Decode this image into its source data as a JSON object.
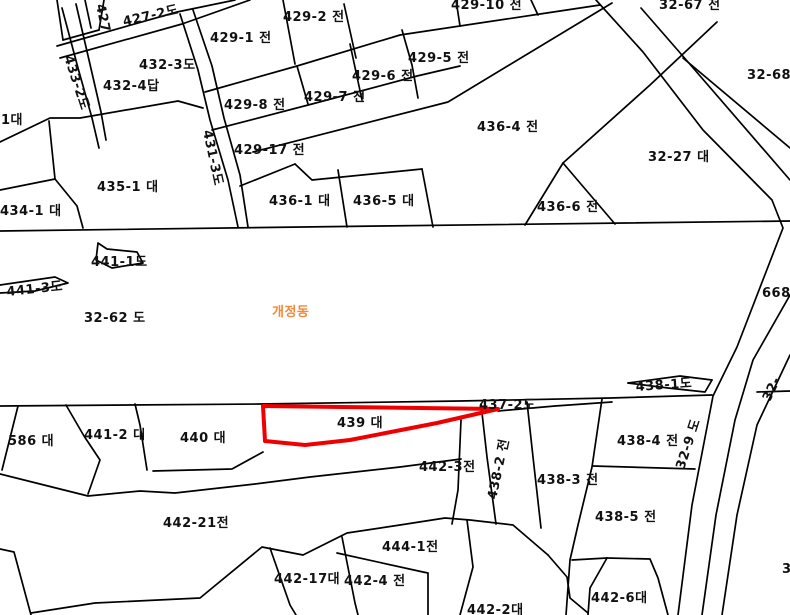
{
  "map": {
    "type": "cadastral-parcel-map",
    "district_name": "개정동",
    "colors": {
      "background": "#ffffff",
      "boundary": "#000000",
      "label": "#111111",
      "district_label": "#f08a3c",
      "highlight": "#ee0000"
    },
    "highlight_parcel": {
      "label": "439 대",
      "points": "263,406 498,409 437,423 350,440 305,445 265,441",
      "stroke_width": 4
    },
    "labels": [
      {
        "text": "427",
        "x": 96,
        "y": 5,
        "rot": 78
      },
      {
        "text": "427-2도",
        "x": 124,
        "y": 26,
        "rot": -13
      },
      {
        "text": "429-2 전",
        "x": 283,
        "y": 21
      },
      {
        "text": "429-1 전",
        "x": 210,
        "y": 42
      },
      {
        "text": "432-3도",
        "x": 139,
        "y": 69
      },
      {
        "text": "432-4답",
        "x": 103,
        "y": 90
      },
      {
        "text": "429-8 전",
        "x": 224,
        "y": 109
      },
      {
        "text": "429-7 전",
        "x": 304,
        "y": 101
      },
      {
        "text": "429-6 전",
        "x": 352,
        "y": 80
      },
      {
        "text": "429-5 전",
        "x": 408,
        "y": 62
      },
      {
        "text": "429-10 전",
        "x": 451,
        "y": 9
      },
      {
        "text": "32-67 전",
        "x": 659,
        "y": 9
      },
      {
        "text": "32-68",
        "x": 747,
        "y": 79
      },
      {
        "text": "429-17 전",
        "x": 234,
        "y": 154
      },
      {
        "text": "433-2도",
        "x": 64,
        "y": 57,
        "rot": 72
      },
      {
        "text": "431-3도",
        "x": 203,
        "y": 131,
        "rot": 78
      },
      {
        "text": "1대",
        "x": 1,
        "y": 124
      },
      {
        "text": "435-1 대",
        "x": 97,
        "y": 191
      },
      {
        "text": "434-1 대",
        "x": 0,
        "y": 215
      },
      {
        "text": "436-1 대",
        "x": 269,
        "y": 205
      },
      {
        "text": "436-5 대",
        "x": 353,
        "y": 205
      },
      {
        "text": "436-4 전",
        "x": 477,
        "y": 131
      },
      {
        "text": "436-6 전",
        "x": 537,
        "y": 211
      },
      {
        "text": "32-27 대",
        "x": 648,
        "y": 161
      },
      {
        "text": "441-1도",
        "x": 91,
        "y": 266
      },
      {
        "text": "441-3도",
        "x": 7,
        "y": 296,
        "rot": -6
      },
      {
        "text": "32-62 도",
        "x": 84,
        "y": 322
      },
      {
        "text": "개정동",
        "x": 272,
        "y": 316,
        "color": "#f08a3c"
      },
      {
        "text": "668",
        "x": 762,
        "y": 297
      },
      {
        "text": "438-1도",
        "x": 636,
        "y": 391,
        "rot": -4
      },
      {
        "text": "32-",
        "x": 770,
        "y": 402,
        "rot": -65
      },
      {
        "text": "437-2도",
        "x": 479,
        "y": 409
      },
      {
        "text": "586 대",
        "x": 8,
        "y": 445
      },
      {
        "text": "441-2 대",
        "x": 84,
        "y": 439
      },
      {
        "text": "440 대",
        "x": 180,
        "y": 442
      },
      {
        "text": "439 대",
        "x": 337,
        "y": 427
      },
      {
        "text": "442-3전",
        "x": 419,
        "y": 471
      },
      {
        "text": "438-2 전",
        "x": 496,
        "y": 500,
        "rot": -78
      },
      {
        "text": "438-3 전",
        "x": 537,
        "y": 484
      },
      {
        "text": "438-4 전",
        "x": 617,
        "y": 445
      },
      {
        "text": "438-5 전",
        "x": 595,
        "y": 521
      },
      {
        "text": "442-21전",
        "x": 163,
        "y": 527
      },
      {
        "text": "444-1전",
        "x": 382,
        "y": 551
      },
      {
        "text": "442-17대",
        "x": 274,
        "y": 583
      },
      {
        "text": "442-4 전",
        "x": 344,
        "y": 585
      },
      {
        "text": "442-2대",
        "x": 467,
        "y": 614
      },
      {
        "text": "442-6대",
        "x": 591,
        "y": 602
      },
      {
        "text": "32-9 도",
        "x": 684,
        "y": 470,
        "rot": -72
      },
      {
        "text": "3",
        "x": 782,
        "y": 573
      }
    ],
    "boundaries": [
      "57,0 63,40",
      "85,0 91,28",
      "104,0 99,30",
      "63,40 99,30",
      "62,8 78,68 92,118 99,148",
      "76,4 89,60 101,112 106,140",
      "57,46 177,12 235,0",
      "60,58 182,24 250,0",
      "180,14 198,70 210,120 228,180 238,227",
      "193,10 212,66 224,118 240,175 248,227",
      "205,92 297,66 400,35 540,14 600,5",
      "283,0 295,64",
      "344,4 356,58",
      "456,0 460,26",
      "531,0 538,15",
      "212,130 312,104 417,76 460,66",
      "297,66 308,104",
      "350,44 362,100",
      "402,30 412,65 418,98",
      "253,152 448,102 612,3",
      "240,186 295,164",
      "295,164 312,180 422,169",
      "338,170 347,227",
      "422,169 433,227",
      "563,163 525,225",
      "563,163 615,224",
      "563,163 650,85 717,22",
      "683,58 790,148",
      "596,0 643,52 703,130 772,200 783,228 737,347 713,396 692,505 678,615",
      "641,8 688,62 790,180",
      "790,295 753,360 735,420 716,515 702,615",
      "790,355 757,425 737,515 722,615",
      "0,231 380,226 790,221",
      "0,406 260,404 460,401 610,398 712,395",
      "757,392 790,391",
      "498,411 555,406 612,402",
      "628,383 680,376 712,380",
      "628,383 668,388 705,392 712,380",
      "98,243 107,249 137,252 143,263 112,268 96,260 98,243",
      "0,285 55,277 68,283 35,291 0,293",
      "18,406 2,470",
      "66,405 84,436 100,460 88,494",
      "0,474 60,489 88,496 140,491 175,493 255,484 310,477 400,467 461,459",
      "461,420 458,490 452,524",
      "135,404 140,425 147,470",
      "153,471 232,469 263,452",
      "0,549 14,552 31,615",
      "31,613 95,603 200,598 262,547 303,555 347,533 400,525 445,518 470,520 513,525 548,555",
      "270,548 290,605 296,615",
      "342,537 355,603 358,615",
      "337,553 423,572 428,573 428,615",
      "467,520 473,567 460,615",
      "548,555 567,577 570,598 588,613",
      "607,558 650,559 658,578 668,615",
      "607,558 590,588 588,615",
      "572,560 607,558",
      "602,399 592,467 578,525 570,560 566,615",
      "481,404 487,457 496,524",
      "527,402 533,457 541,528",
      "593,466 695,469",
      "0,142 50,118 80,118 178,101 203,108",
      "0,190 55,179",
      "55,179 49,121",
      "55,179 77,206 83,228"
    ]
  }
}
